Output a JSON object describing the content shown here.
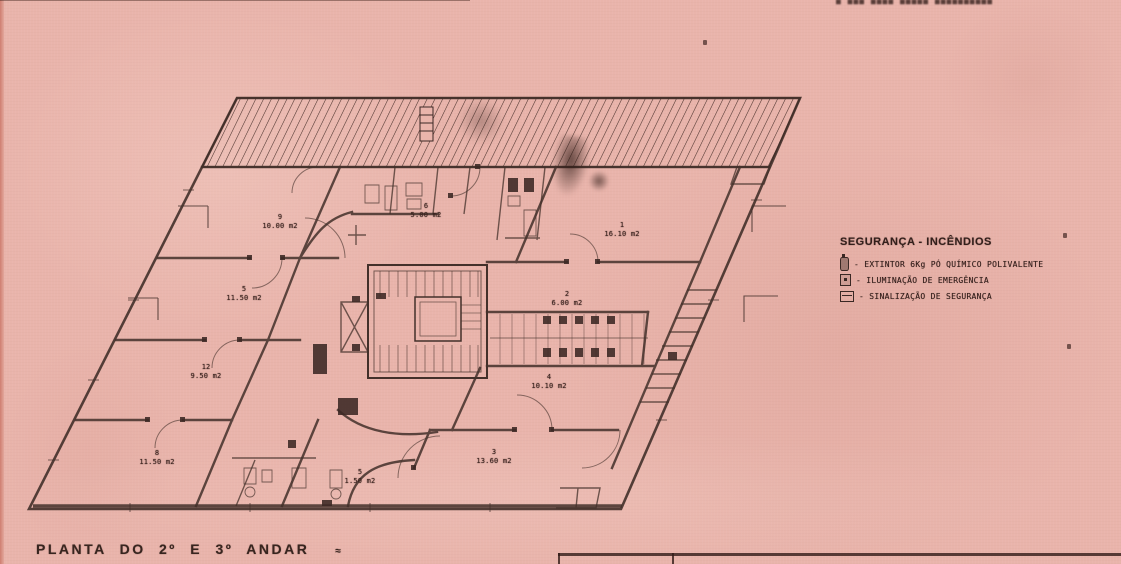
{
  "colors": {
    "paper": "#e9b4ab",
    "ink": "#43302a",
    "paper_edge": "#cf7e71"
  },
  "stamp": {
    "text": "■ ■■■  ■■■■  ■■■■■  ■■■■■■■■■■"
  },
  "legend": {
    "title": "SEGURANÇA - INCÊNDIOS",
    "items": [
      {
        "icon": "icon-extinguisher",
        "name": "extinguisher-icon",
        "label": "- EXTINTOR  6Kg PÓ QUÍMICO POLIVALENTE"
      },
      {
        "icon": "icon-emergency-light",
        "name": "emergency-light-icon",
        "label": "- ILUMINAÇÃO  DE  EMERGÊNCIA"
      },
      {
        "icon": "icon-safety-sign",
        "name": "safety-sign-icon",
        "label": "- SINALIZAÇÃO  DE  SEGURANÇA"
      }
    ]
  },
  "caption": {
    "text": "PLANTA DO 2º E 3º ANDAR",
    "mark": "≈"
  },
  "dimensions": [
    {
      "label": "4.9",
      "x": 168,
      "y": 215
    },
    {
      "label": "4.3",
      "x": 112,
      "y": 303
    },
    {
      "label": "4.3",
      "x": 812,
      "y": 216
    },
    {
      "label": "8.3",
      "x": 790,
      "y": 303
    }
  ],
  "rooms": [
    {
      "number": "9",
      "area": "10.00 m2",
      "x": 280,
      "y": 222
    },
    {
      "number": "5",
      "area": "11.50 m2",
      "x": 244,
      "y": 294
    },
    {
      "number": "12",
      "area": "9.50 m2",
      "x": 206,
      "y": 372
    },
    {
      "number": "8",
      "area": "11.50 m2",
      "x": 157,
      "y": 458
    },
    {
      "number": "6",
      "area": "5.00 m2",
      "x": 426,
      "y": 211
    },
    {
      "number": "1",
      "area": "16.10 m2",
      "x": 622,
      "y": 230
    },
    {
      "number": "2",
      "area": "6.00 m2",
      "x": 567,
      "y": 299
    },
    {
      "number": "4",
      "area": "10.10 m2",
      "x": 549,
      "y": 382
    },
    {
      "number": "3",
      "area": "13.60 m2",
      "x": 494,
      "y": 457
    },
    {
      "number": "5",
      "area": "1.50 m2",
      "x": 360,
      "y": 477
    }
  ],
  "tiny_labels": [
    {
      "text": "TXT",
      "x": 764,
      "y": 177
    },
    {
      "text": "TXT",
      "x": 572,
      "y": 512
    }
  ],
  "specks": [
    {
      "x": 1063,
      "y": 233
    },
    {
      "x": 1067,
      "y": 344
    },
    {
      "x": 703,
      "y": 40
    }
  ]
}
